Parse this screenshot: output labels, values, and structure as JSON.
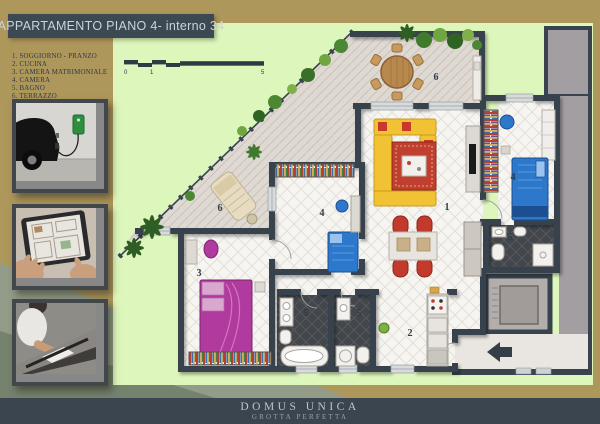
{
  "title": "APPARTAMENTO PIANO 4- interno 34",
  "legend": {
    "items": [
      "1. SOGGIORNO - PRANZO",
      "2. CUCINA",
      "3. CAMERA MATRIMONIALE",
      "4. CAMERA",
      "5. BAGNO",
      "6. TERRAZZO"
    ]
  },
  "scale_bar": {
    "start": "0",
    "mid": "1",
    "end": "5"
  },
  "plan": {
    "room_labels": {
      "living": "1",
      "kitchen": "2",
      "master_bedroom": "3",
      "bedroom_center": "4",
      "bedroom_right": "4",
      "bath_a": "5",
      "bath_b": "5",
      "bath_right": "5",
      "terrace_top": "6",
      "terrace_lower": "6"
    }
  },
  "photos": [
    {
      "name": "electric car charging"
    },
    {
      "name": "tablet with floor plan"
    },
    {
      "name": "architect working at desk"
    }
  ],
  "footer": {
    "title": "DOMUS  UNICA",
    "subtitle": "GROTTA  PERFETTA"
  },
  "colors": {
    "background_tan": "#ae975b",
    "plan_green": "#ddf6bb",
    "wall_slate": "#39434e",
    "footer_slate": "#3a4550",
    "sofa_yellow": "#f1c233",
    "bed_blue": "#2d78cb",
    "bed_magenta": "#b03a9d",
    "rug_red": "#c13f2f",
    "corner_sage": "#939c88"
  }
}
